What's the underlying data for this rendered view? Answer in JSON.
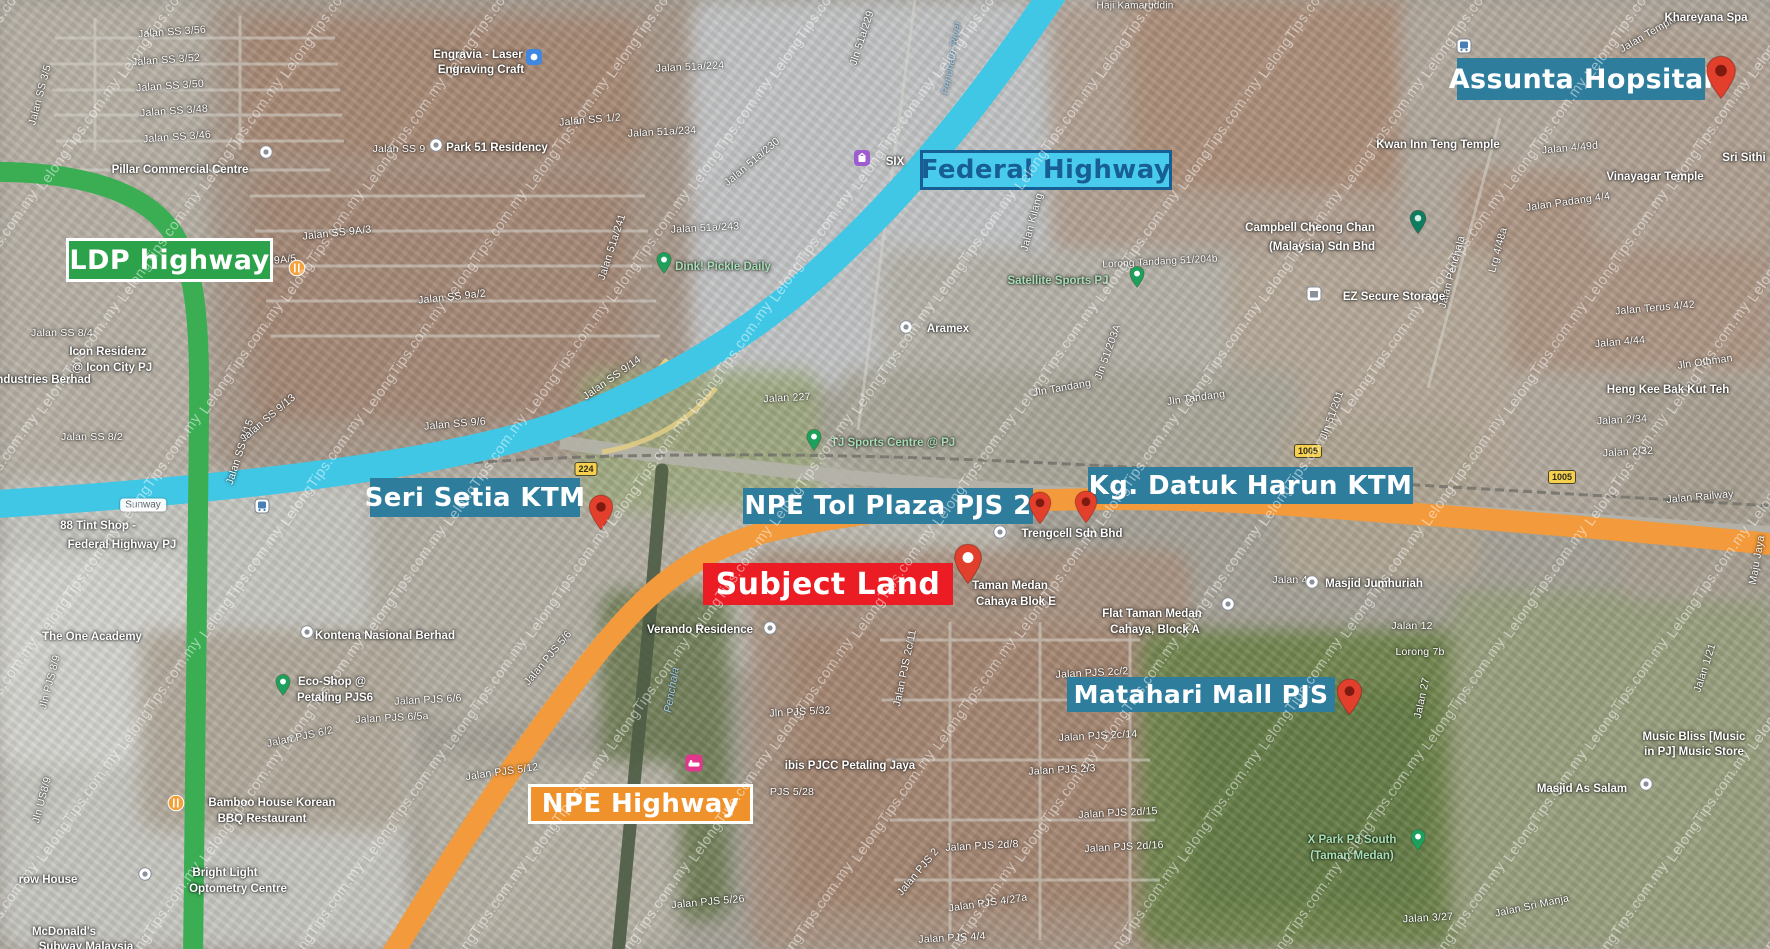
{
  "watermark": {
    "text": "LelongTips.com.my"
  },
  "colors": {
    "teal_label": "#2F7D9D",
    "green_label": "#2CA24A",
    "cyan_label_bg": "#49CBEE",
    "cyan_label_text": "#175E94",
    "red_label": "#EC1C24",
    "orange_label": "#F0922B",
    "label_text": "#FFFFFF",
    "road_federal": "#41C7E6",
    "road_ldp": "#3BAE54",
    "road_npe": "#F29A3C",
    "pin_red": "#E2402C",
    "pin_red_dark": "#7E1A10"
  },
  "overlay_labels": [
    {
      "name": "ldp-highway-label",
      "text": "LDP highway"
    },
    {
      "name": "federal-highway-label",
      "text": "Federal Highway"
    },
    {
      "name": "assunta-hospital-label",
      "text": "Assunta Hopsital"
    },
    {
      "name": "seri-setia-ktm-label",
      "text": "Seri Setia KTM"
    },
    {
      "name": "npe-tol-plaza-label",
      "text": "NPE Tol Plaza PJS 2"
    },
    {
      "name": "kg-datuk-harun-ktm-label",
      "text": "Kg. Datuk Harun KTM"
    },
    {
      "name": "subject-land-label",
      "text": "Subject Land"
    },
    {
      "name": "matahari-mall-label",
      "text": "Matahari Mall PJS"
    },
    {
      "name": "npe-highway-label",
      "text": "NPE Highway"
    }
  ],
  "pins": [
    {
      "name": "assunta-hospital-pin",
      "x": 1721,
      "y": 55,
      "w": 32,
      "h": 45,
      "body": "#E2402C",
      "dot": "#7E1A10"
    },
    {
      "name": "seri-setia-ktm-pin",
      "x": 601,
      "y": 494,
      "w": 26,
      "h": 37,
      "body": "#E2402C",
      "dot": "#7E1A10"
    },
    {
      "name": "npe-tol-plaza-pin",
      "x": 1040,
      "y": 491,
      "w": 24,
      "h": 34,
      "body": "#E2402C",
      "dot": "#7E1A10"
    },
    {
      "name": "kg-datuk-harun-ktm-pin",
      "x": 1086,
      "y": 490,
      "w": 24,
      "h": 34,
      "body": "#E2402C",
      "dot": "#7E1A10"
    },
    {
      "name": "subject-land-pin",
      "x": 968,
      "y": 543,
      "w": 30,
      "h": 42,
      "body": "#E2402C",
      "dot": "#FFFFFF"
    },
    {
      "name": "matahari-mall-pin",
      "x": 1349,
      "y": 678,
      "w": 27,
      "h": 38,
      "body": "#E2402C",
      "dot": "#7E1A10"
    }
  ],
  "route_badges": [
    {
      "text": "224",
      "x": 586,
      "y": 469
    },
    {
      "text": "1005",
      "x": 1308,
      "y": 451
    },
    {
      "text": "1005",
      "x": 1562,
      "y": 477
    }
  ],
  "map_icons": [
    {
      "type": "bus",
      "x": 262,
      "y": 506
    },
    {
      "type": "bus",
      "x": 1464,
      "y": 46
    },
    {
      "type": "restaurant",
      "x": 297,
      "y": 268
    },
    {
      "type": "restaurant",
      "x": 176,
      "y": 803
    },
    {
      "type": "hotel",
      "x": 694,
      "y": 763
    },
    {
      "type": "shop-purple",
      "x": 862,
      "y": 158
    },
    {
      "type": "shop-blue",
      "x": 534,
      "y": 57
    },
    {
      "type": "storage",
      "x": 1314,
      "y": 294
    },
    {
      "type": "pin-green",
      "x": 664,
      "y": 263
    },
    {
      "type": "pin-green",
      "x": 1137,
      "y": 277
    },
    {
      "type": "pin-green",
      "x": 814,
      "y": 440
    },
    {
      "type": "pin-green",
      "x": 283,
      "y": 685
    },
    {
      "type": "pin-green",
      "x": 1418,
      "y": 840
    },
    {
      "type": "pin-dark",
      "x": 1418,
      "y": 222
    },
    {
      "type": "dot",
      "x": 266,
      "y": 152
    },
    {
      "type": "dot",
      "x": 906,
      "y": 327
    },
    {
      "type": "dot",
      "x": 307,
      "y": 632
    },
    {
      "type": "dot",
      "x": 770,
      "y": 628
    },
    {
      "type": "dot",
      "x": 1000,
      "y": 532
    },
    {
      "type": "dot",
      "x": 1312,
      "y": 582
    },
    {
      "type": "dot",
      "x": 1228,
      "y": 604
    },
    {
      "type": "dot",
      "x": 145,
      "y": 874
    },
    {
      "type": "dot",
      "x": 1646,
      "y": 784
    },
    {
      "type": "dot",
      "x": 436,
      "y": 145
    }
  ],
  "map_text": {
    "streets": [
      {
        "t": "Jalan SS 3/56",
        "x": 172,
        "y": 32,
        "r": -4
      },
      {
        "t": "Jalan SS 3/52",
        "x": 166,
        "y": 60,
        "r": -4
      },
      {
        "t": "Jalan SS 3/50",
        "x": 170,
        "y": 86,
        "r": -4
      },
      {
        "t": "Jalan SS 3/48",
        "x": 174,
        "y": 111,
        "r": -4
      },
      {
        "t": "Jalan SS 3/46",
        "x": 177,
        "y": 137,
        "r": -4
      },
      {
        "t": "Jalan SS 3/5",
        "x": 40,
        "y": 95,
        "r": -75
      },
      {
        "t": "Jalan SS 1/2",
        "x": 590,
        "y": 120,
        "r": -5
      },
      {
        "t": "Jalan SS 9",
        "x": 399,
        "y": 149,
        "r": 0
      },
      {
        "t": "Jalan SS 9A/3",
        "x": 337,
        "y": 233,
        "r": -6
      },
      {
        "t": "Jalan SS 9A/5",
        "x": 262,
        "y": 262,
        "r": -6
      },
      {
        "t": "Jalan SS 9a/2",
        "x": 452,
        "y": 297,
        "r": -6
      },
      {
        "t": "Jalan SS 9/6",
        "x": 455,
        "y": 424,
        "r": -5
      },
      {
        "t": "Jalan SS 9/14",
        "x": 612,
        "y": 378,
        "r": -35
      },
      {
        "t": "Jalan SS 9/15",
        "x": 240,
        "y": 452,
        "r": -72
      },
      {
        "t": "Jalan SS 9/13",
        "x": 268,
        "y": 418,
        "r": -40
      },
      {
        "t": "Jalan SS 8/4",
        "x": 62,
        "y": 333,
        "r": 0
      },
      {
        "t": "Jalan SS 8/2",
        "x": 92,
        "y": 437,
        "r": 0
      },
      {
        "t": "Jalan 51a/224",
        "x": 690,
        "y": 67,
        "r": -3
      },
      {
        "t": "Jln 51a/229",
        "x": 862,
        "y": 38,
        "r": -72
      },
      {
        "t": "Jalan 51a/234",
        "x": 662,
        "y": 132,
        "r": -3
      },
      {
        "t": "Jalan 51a/230",
        "x": 752,
        "y": 162,
        "r": -40
      },
      {
        "t": "Jalan 51a/241",
        "x": 612,
        "y": 247,
        "r": -72
      },
      {
        "t": "Jalan 51a/243",
        "x": 705,
        "y": 228,
        "r": -3
      },
      {
        "t": "Jalan 227",
        "x": 787,
        "y": 398,
        "r": -3
      },
      {
        "t": "Jalan Kilang",
        "x": 1032,
        "y": 222,
        "r": -75
      },
      {
        "t": "Lorong Tandang 51/204b",
        "x": 1160,
        "y": 262,
        "r": -3,
        "fs": 10
      },
      {
        "t": "Jln Tandang",
        "x": 1062,
        "y": 388,
        "r": -10
      },
      {
        "t": "Jln Tandang",
        "x": 1196,
        "y": 398,
        "r": -8
      },
      {
        "t": "Jln 51/203A",
        "x": 1108,
        "y": 352,
        "r": -70
      },
      {
        "t": "Jln 51/201",
        "x": 1332,
        "y": 415,
        "r": -70
      },
      {
        "t": "Jalan Penchala",
        "x": 1452,
        "y": 272,
        "r": -75
      },
      {
        "t": "Lrg 4/48a",
        "x": 1498,
        "y": 250,
        "r": -75
      },
      {
        "t": "Jalan Templer",
        "x": 1650,
        "y": 33,
        "r": -30
      },
      {
        "t": "Haji Kamaruddin",
        "x": 1135,
        "y": 6,
        "r": 0,
        "fs": 10
      },
      {
        "t": "Jalan 4/49d",
        "x": 1570,
        "y": 148,
        "r": -5
      },
      {
        "t": "Jalan Padang 4/4",
        "x": 1568,
        "y": 202,
        "r": -8
      },
      {
        "t": "Jalan Terus 4/42",
        "x": 1655,
        "y": 308,
        "r": -5
      },
      {
        "t": "Jln Othman",
        "x": 1705,
        "y": 362,
        "r": -8
      },
      {
        "t": "Jalan 4/44",
        "x": 1620,
        "y": 342,
        "r": -5
      },
      {
        "t": "Jalan 2/34",
        "x": 1622,
        "y": 420,
        "r": -3
      },
      {
        "t": "Jalan 2/32",
        "x": 1628,
        "y": 452,
        "r": -3
      },
      {
        "t": "Jalan Railway",
        "x": 1700,
        "y": 497,
        "r": -5
      },
      {
        "t": "Jalan 4",
        "x": 1290,
        "y": 580,
        "r": 0
      },
      {
        "t": "Jalan 12",
        "x": 1412,
        "y": 626,
        "r": 0
      },
      {
        "t": "Lorong 7b",
        "x": 1420,
        "y": 652,
        "r": 0
      },
      {
        "t": "Jalan 27",
        "x": 1422,
        "y": 698,
        "r": -78
      },
      {
        "t": "Jalan 1/21",
        "x": 1705,
        "y": 668,
        "r": -72
      },
      {
        "t": "Maju Jaya",
        "x": 1757,
        "y": 560,
        "r": -80
      },
      {
        "t": "Jln PJS 8/9",
        "x": 50,
        "y": 682,
        "r": -75
      },
      {
        "t": "Jln US8/9",
        "x": 42,
        "y": 800,
        "r": -75
      },
      {
        "t": "Jalan PJS 6/2",
        "x": 300,
        "y": 737,
        "r": -12
      },
      {
        "t": "Jalan PJS 6/5a",
        "x": 392,
        "y": 718,
        "r": -3
      },
      {
        "t": "Jalan PJS 6/6",
        "x": 428,
        "y": 700,
        "r": -3
      },
      {
        "t": "Jalan PJS 5/6",
        "x": 548,
        "y": 658,
        "r": -50
      },
      {
        "t": "Jln PJS 5/32",
        "x": 800,
        "y": 712,
        "r": -3
      },
      {
        "t": "Jalan PJS 5/12",
        "x": 502,
        "y": 772,
        "r": -8
      },
      {
        "t": "PJS 5/28",
        "x": 792,
        "y": 792,
        "r": 0
      },
      {
        "t": "Jalan PJS 5/26",
        "x": 708,
        "y": 902,
        "r": -5
      },
      {
        "t": "Jalan PJS 2c/11",
        "x": 905,
        "y": 668,
        "r": -78
      },
      {
        "t": "Jalan PJS 2c/2",
        "x": 1092,
        "y": 673,
        "r": -3
      },
      {
        "t": "Jalan PJS 2c/14",
        "x": 1098,
        "y": 736,
        "r": -3
      },
      {
        "t": "Jalan PJS 2/3",
        "x": 1062,
        "y": 770,
        "r": -3
      },
      {
        "t": "Jalan PJS 2d/15",
        "x": 1118,
        "y": 813,
        "r": -3
      },
      {
        "t": "Jalan PJS 2d/8",
        "x": 982,
        "y": 846,
        "r": -3
      },
      {
        "t": "Jalan PJS 2d/16",
        "x": 1124,
        "y": 847,
        "r": -3
      },
      {
        "t": "Jalan PJS 2",
        "x": 918,
        "y": 872,
        "r": -50
      },
      {
        "t": "Jalan PJS 4/27a",
        "x": 988,
        "y": 903,
        "r": -8
      },
      {
        "t": "Jalan PJS 4/4",
        "x": 952,
        "y": 938,
        "r": -3
      },
      {
        "t": "Jalan Sri Manja",
        "x": 1532,
        "y": 906,
        "r": -12
      },
      {
        "t": "Jalan 3/27",
        "x": 1428,
        "y": 918,
        "r": -3
      }
    ],
    "pois": [
      {
        "t": "Pillar Commercial Centre",
        "x": 180,
        "y": 170
      },
      {
        "t": "Engravia - Laser",
        "x": 478,
        "y": 55
      },
      {
        "t": "Engraving Craft",
        "x": 481,
        "y": 70
      },
      {
        "t": "Park 51 Residency",
        "x": 497,
        "y": 148
      },
      {
        "t": "SIX",
        "x": 895,
        "y": 162
      },
      {
        "t": "Craft Motor",
        "x": 1082,
        "y": 160
      },
      {
        "t": "Campbell Cheong Chan",
        "x": 1310,
        "y": 228
      },
      {
        "t": "(Malaysia) Sdn Bhd",
        "x": 1322,
        "y": 247
      },
      {
        "t": "EZ Secure Storage",
        "x": 1394,
        "y": 297
      },
      {
        "t": "Aramex",
        "x": 948,
        "y": 329
      },
      {
        "t": "Kwan Inn Teng Temple",
        "x": 1438,
        "y": 145
      },
      {
        "t": "Vinayagar Temple",
        "x": 1655,
        "y": 177
      },
      {
        "t": "Sri Sithi",
        "x": 1744,
        "y": 158
      },
      {
        "t": "Heng Kee Bak Kut Teh",
        "x": 1668,
        "y": 390
      },
      {
        "t": "Khareyana Spa",
        "x": 1706,
        "y": 18
      },
      {
        "t": "Icon Residenz",
        "x": 108,
        "y": 352
      },
      {
        "t": "@ Icon City PJ",
        "x": 112,
        "y": 368
      },
      {
        "t": "Industries Berhad",
        "x": 42,
        "y": 380
      },
      {
        "t": "88 Tint Shop -",
        "x": 98,
        "y": 526
      },
      {
        "t": "Federal Highway PJ",
        "x": 122,
        "y": 545
      },
      {
        "t": "The One Academy",
        "x": 92,
        "y": 637
      },
      {
        "t": "Kontena Nasional Berhad",
        "x": 385,
        "y": 636
      },
      {
        "t": "Eco-Shop @",
        "x": 332,
        "y": 682
      },
      {
        "t": "Petaling PJS6",
        "x": 335,
        "y": 698
      },
      {
        "t": "Verando Residence",
        "x": 700,
        "y": 630
      },
      {
        "t": "Trengcell Sdn Bhd",
        "x": 1072,
        "y": 534
      },
      {
        "t": "Taman Medan",
        "x": 1010,
        "y": 586
      },
      {
        "t": "Cahaya Blok E",
        "x": 1016,
        "y": 602
      },
      {
        "t": "Flat Taman Medan",
        "x": 1152,
        "y": 614
      },
      {
        "t": "Cahaya, Block A",
        "x": 1155,
        "y": 630
      },
      {
        "t": "Masjid Jumhuriah",
        "x": 1374,
        "y": 584
      },
      {
        "t": "ibis PJCC Petaling Jaya",
        "x": 850,
        "y": 766
      },
      {
        "t": "Bamboo House Korean",
        "x": 272,
        "y": 803
      },
      {
        "t": "BBQ Restaurant",
        "x": 262,
        "y": 819
      },
      {
        "t": "Bright Light",
        "x": 225,
        "y": 873
      },
      {
        "t": "Optometry Centre",
        "x": 238,
        "y": 889
      },
      {
        "t": "row House",
        "x": 48,
        "y": 880
      },
      {
        "t": "McDonald's",
        "x": 64,
        "y": 932
      },
      {
        "t": "Subway Malaysia",
        "x": 86,
        "y": 947
      },
      {
        "t": "Masjid As Salam",
        "x": 1582,
        "y": 789
      },
      {
        "t": "Music Bliss [Music",
        "x": 1694,
        "y": 737
      },
      {
        "t": "in PJ] Music Store",
        "x": 1694,
        "y": 752
      }
    ],
    "parks": [
      {
        "t": "Dink! Pickle Daily",
        "x": 723,
        "y": 267
      },
      {
        "t": "Satellite Sports PJ",
        "x": 1058,
        "y": 281
      },
      {
        "t": "TJ Sports Centre @ PJ",
        "x": 893,
        "y": 443
      },
      {
        "t": "X Park PJ South",
        "x": 1352,
        "y": 840
      },
      {
        "t": "(Taman Medan)",
        "x": 1352,
        "y": 856
      }
    ],
    "water": [
      {
        "t": "Penchala River",
        "x": 952,
        "y": 58,
        "r": -80
      },
      {
        "t": "Penchala",
        "x": 672,
        "y": 690,
        "r": -80
      }
    ],
    "chips": [
      {
        "t": "Sunway",
        "x": 143,
        "y": 505
      }
    ]
  }
}
